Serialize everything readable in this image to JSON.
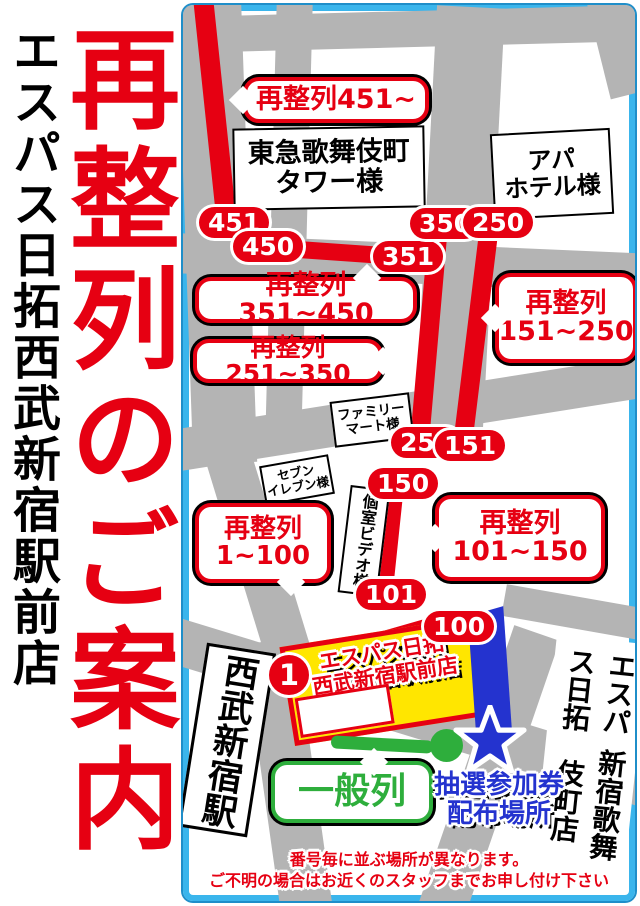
{
  "left_panel": {
    "store_name": "エスパス日拓西武新宿駅前店",
    "title": "再整列のご案内"
  },
  "map": {
    "callouts": {
      "c451": "再整列451~",
      "c351_450": "再整列351~450",
      "c251_350": "再整列251~350",
      "c151_250_l1": "再整列",
      "c151_250_l2": "151~250",
      "c101_150_l1": "再整列",
      "c101_150_l2": "101~150",
      "c1_100_l1": "再整列",
      "c1_100_l2": "1~100",
      "general_line": "一般列"
    },
    "markers": {
      "m451": "451",
      "m450": "450",
      "m351": "351",
      "m350": "350",
      "m250": "250",
      "m251": "251",
      "m151": "151",
      "m150": "150",
      "m101": "101",
      "m100": "100",
      "m1": "1"
    },
    "buildings": {
      "tokyu_l1": "東急歌舞伎町",
      "tokyu_l2": "タワー様",
      "apa_l1": "アパ",
      "apa_l2": "ホテル様",
      "familymart_l1": "ファミリー",
      "familymart_l2": "マート様",
      "seveneleven_l1": "セブン",
      "seveneleven_l2": "イレブン様",
      "video_booth": "個室ビデオ様",
      "seibu_station": "西武新宿駅",
      "kabukicho_store_l1": "エスパス日拓",
      "kabukicho_store_l2": "新宿歌舞伎町店"
    },
    "store": {
      "l1": "エスパス日拓",
      "l2": "西武新宿駅前店"
    },
    "lottery": {
      "l1": "抽選参加券",
      "l2": "配布場所"
    },
    "notice": {
      "l1": "番号毎に並ぶ場所が異なります。",
      "l2": "ご不明の場合はお近くのスタッフまでお申し付け下さい"
    }
  },
  "colors": {
    "red": "#e60012",
    "cyan_border": "#3ab5ec",
    "street_gray": "#b4b4b4",
    "store_yellow": "#ffe600",
    "blue": "#2433cf",
    "green": "#2eae3c"
  }
}
